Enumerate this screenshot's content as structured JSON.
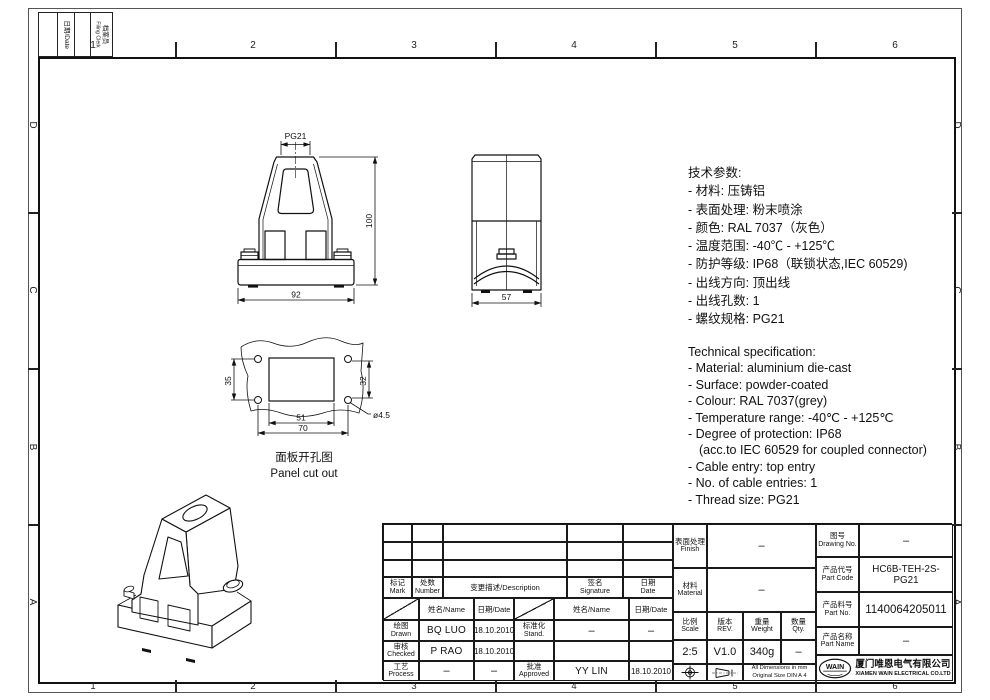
{
  "sheet": {
    "zones": {
      "columns": [
        "1",
        "2",
        "3",
        "4",
        "5",
        "6"
      ],
      "rows": [
        "D",
        "C",
        "B",
        "A"
      ]
    },
    "filing": {
      "date": "日期/Date",
      "clerk_zh": "档案员",
      "clerk_en": "Filing Clerk"
    }
  },
  "views": {
    "front": {
      "thread": "PG21",
      "height": "100",
      "width": "92"
    },
    "side": {
      "width": "57"
    },
    "cutout": {
      "v_left": "35",
      "v_right": "32",
      "w_inner": "51",
      "w_outer": "70",
      "hole": "ø4.5",
      "caption_zh": "面板开孔图",
      "caption_en": "Panel cut out"
    }
  },
  "spec_zh": {
    "title": "技术参数:",
    "lines": [
      "- 材料: 压铸铝",
      "- 表面处理: 粉末喷涂",
      "- 颜色: RAL 7037（灰色）",
      "- 温度范围: -40℃ - +125℃",
      "- 防护等级: IP68（联锁状态,IEC 60529)",
      "- 出线方向: 顶出线",
      "- 出线孔数: 1",
      "- 螺纹规格: PG21"
    ]
  },
  "spec_en": {
    "title": "Technical specification:",
    "lines": [
      "- Material: aluminium die-cast",
      "- Surface: powder-coated",
      "- Colour: RAL 7037(grey)",
      "- Temperature range: -40℃ - +125℃",
      "- Degree of protection: IP68",
      "(acc.to IEC 60529 for coupled connector)",
      "- Cable entry: top entry",
      "- No. of cable entries: 1",
      "- Thread size: PG21"
    ]
  },
  "tb": {
    "rev_cols": {
      "mark_zh": "标记",
      "mark_en": "Mark",
      "number_zh": "处数",
      "number_en": "Number",
      "desc": "变更描述/Description",
      "sig_zh": "签名",
      "sig_en": "Signature",
      "date_zh": "日期",
      "date_en": "Date"
    },
    "subheader": {
      "name": "姓名/Name",
      "date": "日期/Date"
    },
    "rows": {
      "drawn": {
        "zh": "绘图",
        "en": "Drawn",
        "name": "BQ LUO",
        "date": "18.10.2010"
      },
      "checked": {
        "zh": "审核",
        "en": "Checked",
        "name": "P RAO",
        "date": "18.10.2010"
      },
      "process": {
        "zh": "工艺",
        "en": "Process",
        "name": "–",
        "date": "–"
      },
      "stand": {
        "zh": "标准化",
        "en": "Stand.",
        "name": "–",
        "date": "–"
      },
      "approved": {
        "zh": "批准",
        "en": "Approved",
        "name": "YY LIN",
        "date": "18.10.2010"
      }
    },
    "finish": {
      "zh": "表面处理",
      "en": "Finish",
      "value": "–"
    },
    "material": {
      "zh": "材料",
      "en": "Material",
      "value": "–"
    },
    "scale": {
      "zh": "比例",
      "en": "Scale",
      "value": "2:5"
    },
    "rev": {
      "zh": "版本",
      "en": "REV.",
      "value": "V1.0"
    },
    "weight": {
      "zh": "重量",
      "en": "Weight",
      "value": "340g"
    },
    "qty": {
      "zh": "数量",
      "en": "Qty.",
      "value": "–"
    },
    "note1": "All Dimensions in mm",
    "note2": "Original Size DIN A 4",
    "drawing_no": {
      "zh": "图号",
      "en": "Drawing No.",
      "value": "–"
    },
    "part_code": {
      "zh": "产品代号",
      "en": "Part Code",
      "value": "HC6B-TEH-2S-PG21"
    },
    "part_no": {
      "zh": "产品料号",
      "en": "Part No.",
      "value": "1140064205011"
    },
    "part_name": {
      "zh": "产品名称",
      "en": "Part Name",
      "value": "–"
    },
    "company": {
      "logo": "WAIN",
      "zh": "厦门唯恩电气有限公司",
      "en": "XIAMEN WAIN ELECTRICAL CO.LTD"
    }
  }
}
